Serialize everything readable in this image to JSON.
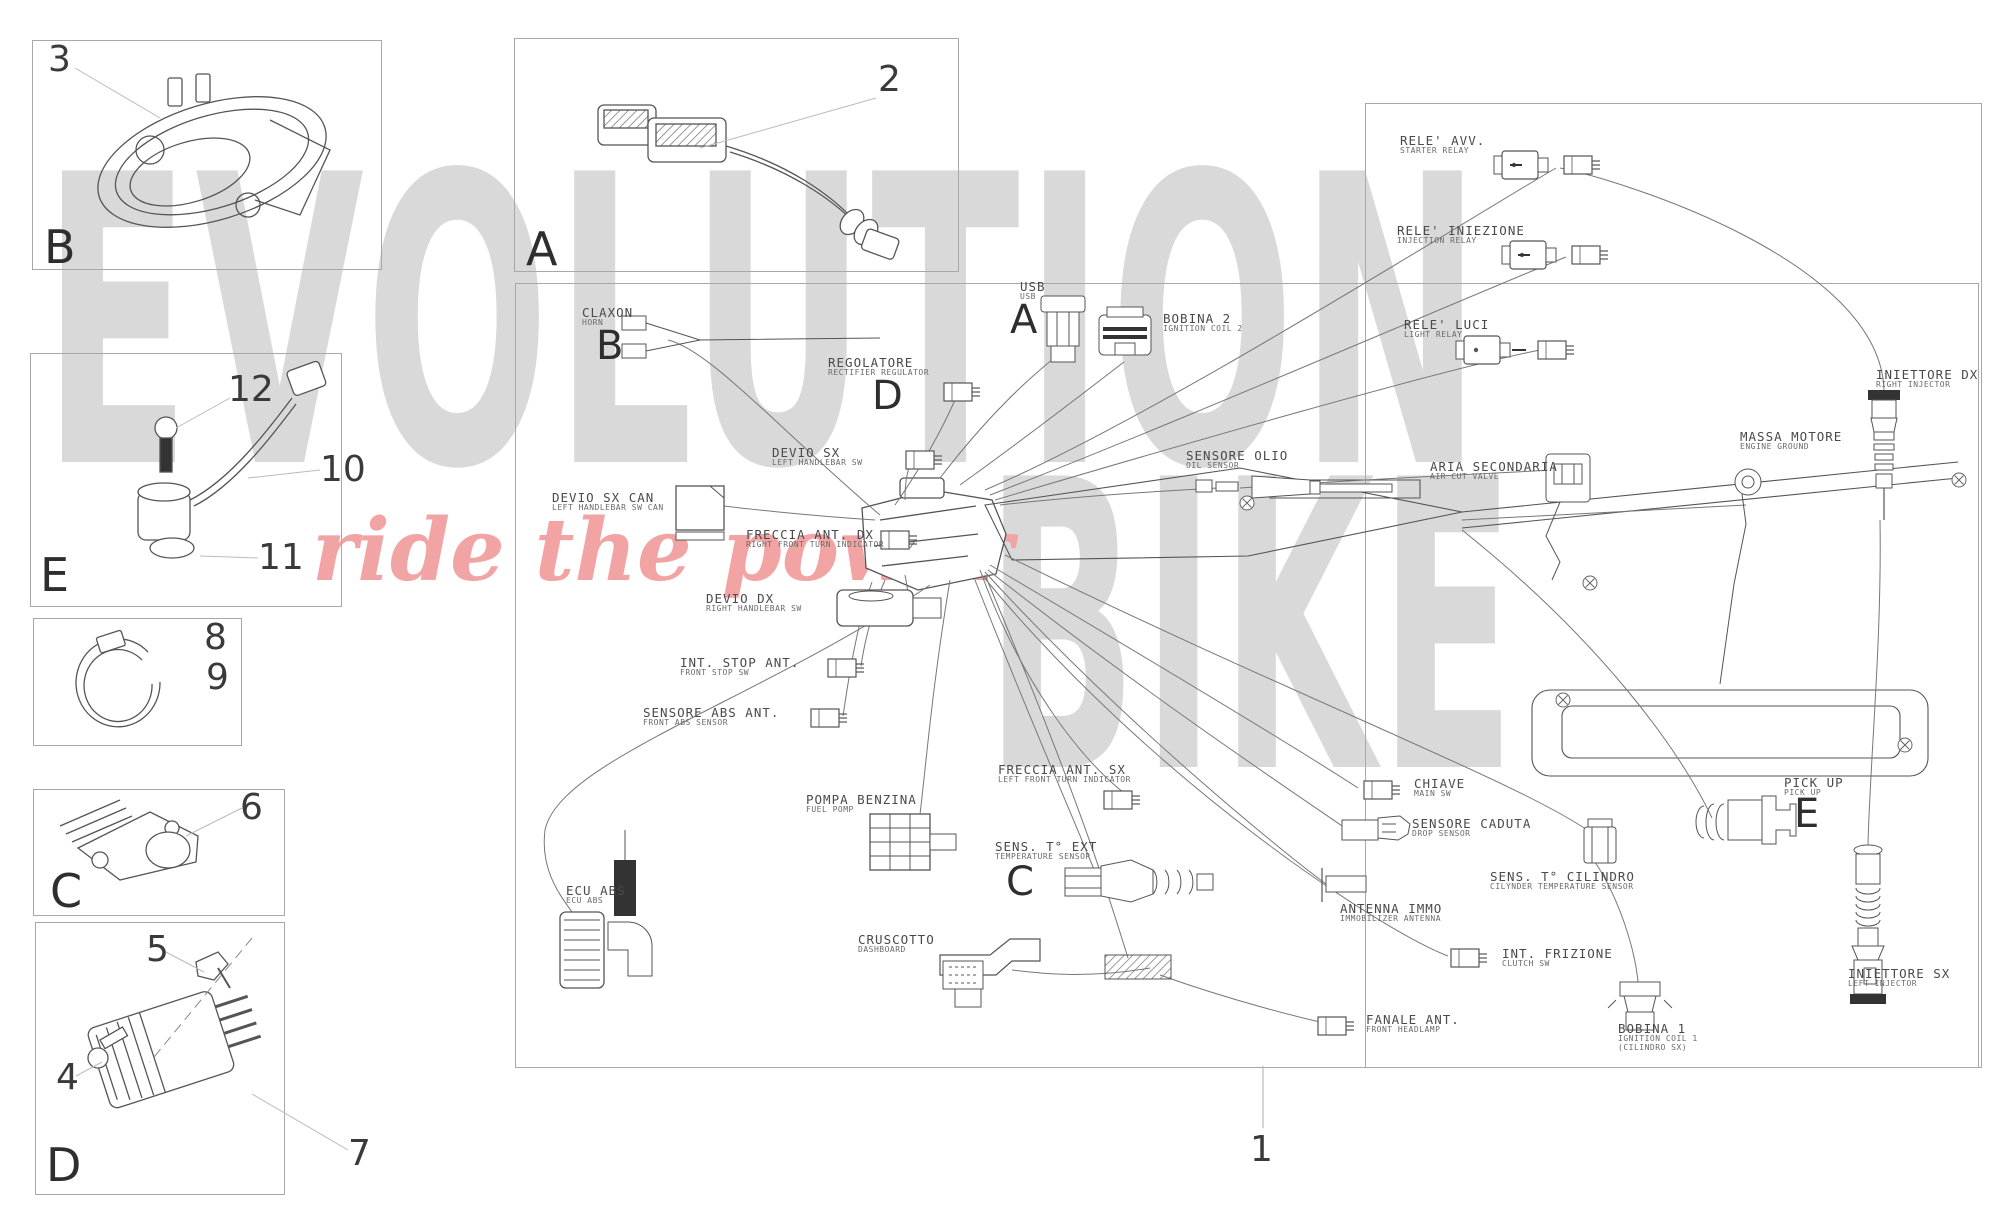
{
  "watermark": {
    "word1": "EVOLUTION",
    "word2": "BIKE",
    "tagline": "ride the power"
  },
  "panels": {
    "b": {
      "letter": "B",
      "callouts": [
        "3"
      ]
    },
    "a": {
      "letter": "A",
      "callouts": [
        "2"
      ]
    },
    "e": {
      "letter": "E",
      "callouts": [
        "12",
        "10",
        "11"
      ]
    },
    "clip": {
      "callouts": [
        "8",
        "9"
      ]
    },
    "c": {
      "letter": "C",
      "callouts": [
        "6"
      ]
    },
    "d": {
      "letter": "D",
      "callouts": [
        "5",
        "4",
        "7"
      ]
    }
  },
  "diagram": {
    "callout": "1",
    "markers": {
      "a": "A",
      "b": "B",
      "c": "C",
      "d": "D",
      "e": "E"
    },
    "labels": {
      "claxon": {
        "name": "CLAXON",
        "sub": "HORN"
      },
      "regolatore": {
        "name": "REGOLATORE",
        "sub": "RECTIFIER REGULATOR"
      },
      "devio_sx": {
        "name": "DEVIO SX",
        "sub": "LEFT HANDLEBAR SW"
      },
      "devio_sx_can": {
        "name": "DEVIO SX CAN",
        "sub": "LEFT HANDLEBAR SW CAN"
      },
      "freccia_dx": {
        "name": "FRECCIA ANT. DX",
        "sub": "RIGHT FRONT TURN INDICATOR"
      },
      "devio_dx": {
        "name": "DEVIO DX",
        "sub": "RIGHT HANDLEBAR SW"
      },
      "int_stop": {
        "name": "INT. STOP ANT.",
        "sub": "FRONT STOP SW"
      },
      "abs": {
        "name": "SENSORE ABS ANT.",
        "sub": "FRONT ABS SENSOR"
      },
      "usb": {
        "name": "USB",
        "sub": "USB"
      },
      "bobina2": {
        "name": "BOBINA 2",
        "sub": "IGNITION COIL 2"
      },
      "sensore_olio": {
        "name": "SENSORE OLIO",
        "sub": "OIL SENSOR"
      },
      "aria": {
        "name": "ARIA SECONDARIA",
        "sub": "AIR CUT VALVE"
      },
      "massa": {
        "name": "MASSA MOTORE",
        "sub": "ENGINE GROUND"
      },
      "iniettore_dx": {
        "name": "INIETTORE DX",
        "sub": "RIGHT INJECTOR"
      },
      "rele_avv": {
        "name": "RELE' AVV.",
        "sub": "STARTER RELAY"
      },
      "rele_iniezione": {
        "name": "RELE' INIEZIONE",
        "sub": "INJECTION RELAY"
      },
      "rele_luci": {
        "name": "RELE' LUCI",
        "sub": "LIGHT RELAY"
      },
      "freccia_sx": {
        "name": "FRECCIA ANT. SX",
        "sub": "LEFT FRONT TURN INDICATOR"
      },
      "pompa": {
        "name": "POMPA BENZINA",
        "sub": "FUEL POMP"
      },
      "sens_t_ext": {
        "name": "SENS. T° EXT",
        "sub": "TEMPERATURE SENSOR"
      },
      "ecu_abs": {
        "name": "ECU ABS",
        "sub": "ECU ABS"
      },
      "cruscotto": {
        "name": "CRUSCOTTO",
        "sub": "DASHBOARD"
      },
      "chiave": {
        "name": "CHIAVE",
        "sub": "MAIN SW"
      },
      "caduta": {
        "name": "SENSORE CADUTA",
        "sub": "DROP SENSOR"
      },
      "antenna": {
        "name": "ANTENNA IMMO",
        "sub": "IMMOBILIZER ANTENNA"
      },
      "frizione": {
        "name": "INT. FRIZIONE",
        "sub": "CLUTCH SW"
      },
      "fanale": {
        "name": "FANALE ANT.",
        "sub": "FRONT HEADLAMP"
      },
      "cilindro": {
        "name": "SENS. T° CILINDRO",
        "sub": "CILYNDER TEMPERATURE SENSOR"
      },
      "bobina1": {
        "name": "BOBINA 1",
        "sub": "IGNITION COIL 1",
        "sub2": "(CILINDRO SX)"
      },
      "pickup": {
        "name": "PICK UP",
        "sub": "PICK UP"
      },
      "iniettore_sx": {
        "name": "INIETTORE SX",
        "sub": "LEFT INJECTOR"
      }
    }
  }
}
